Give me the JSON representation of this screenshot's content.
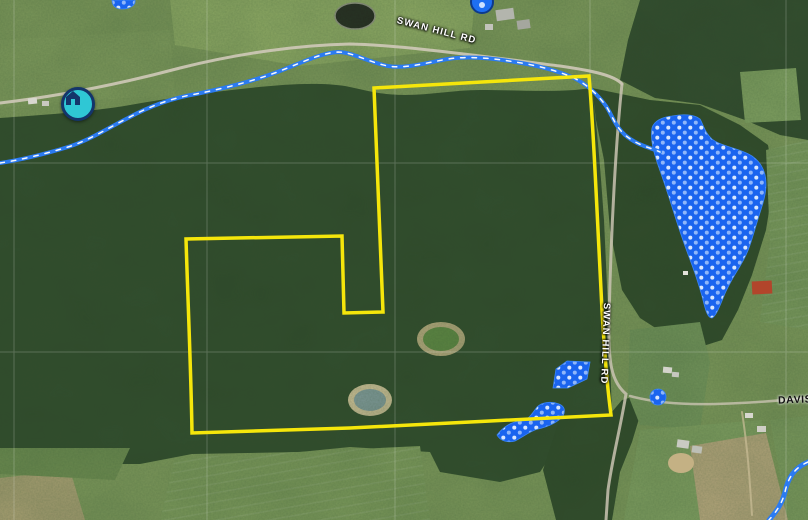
{
  "map": {
    "view": "satellite",
    "labels": {
      "road_top": "SWAN HILL RD",
      "road_right": "SWAN HILL RD",
      "road_east": "DAVIS"
    },
    "markers": [
      {
        "id": "home-marker",
        "icon": "house-icon",
        "fill": "#2fc7d5",
        "ring": "#14356b"
      },
      {
        "id": "poi-marker",
        "icon": "dot-icon",
        "fill": "#1e6ff2",
        "ring": "#0d3a8c"
      }
    ],
    "colors": {
      "parcel_boundary": "#f5e60b",
      "wetland_fill": "#1a64ef",
      "wetland_dot_light": "#8fb6fa",
      "wetland_dot_white": "#d8e7ff",
      "stream": "#2b7bf2",
      "stream_dashes": "#ffffff",
      "road_label_text": "#ffffff",
      "east_label_text": "#121212"
    }
  }
}
